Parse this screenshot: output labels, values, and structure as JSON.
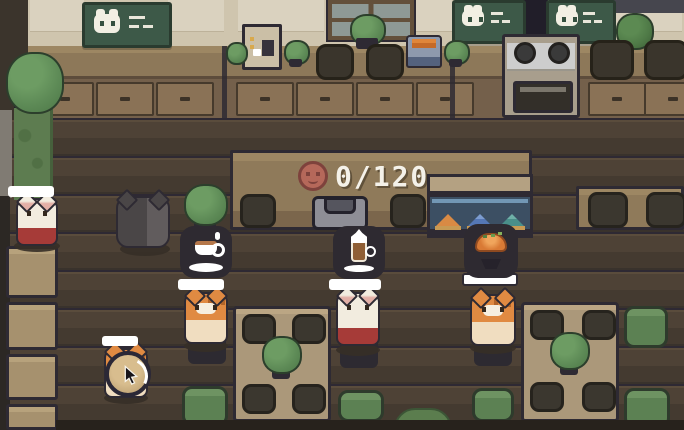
{
  "hud": {
    "order_counter": {
      "icon": "coin-icon",
      "value": "0/120"
    }
  },
  "signs": {
    "menu_boards": [
      {
        "name": "menu-board-left",
        "icon": "cat-face-icon",
        "content": "menu-lines"
      },
      {
        "name": "menu-board-right-1",
        "icon": "cat-face-icon",
        "content": "menu-lines"
      },
      {
        "name": "menu-board-right-2",
        "icon": "cat-face-icon",
        "content": "menu-lines"
      }
    ]
  },
  "entities": {
    "customers": [
      {
        "name": "customer-cat-left",
        "species": "orange-tabby",
        "order_icon": "coffee-cup-icon"
      },
      {
        "name": "customer-cat-center",
        "species": "white-cat",
        "order_icon": "latte-icon"
      },
      {
        "name": "customer-cat-right",
        "species": "orange-tabby",
        "order_icon": "katsu-bowl-icon"
      }
    ],
    "staff": [
      {
        "name": "staff-cat",
        "species": "white-cat-red-apron"
      },
      {
        "name": "black-cat",
        "species": "black-cat"
      }
    ],
    "waiting": [
      {
        "name": "waiting-cat",
        "species": "orange-tabby",
        "indicator": "clock-icon",
        "cursor": "cursor-icon"
      }
    ],
    "kitchen": [
      "espresso-machine",
      "toaster",
      "stove",
      "display-case",
      "serving-tray"
    ],
    "display_case_items": [
      "sandwich-orange",
      "sandwich-blue",
      "sandwich-teal"
    ]
  },
  "palette": {
    "wall": "#cfc5ae",
    "wall_light": "#dad2bf",
    "wood_counter": "#8d7859",
    "wood_cabinet": "#74604b",
    "drawer": "#8a7256",
    "floor_a": "#4e4236",
    "floor_b": "#443a30",
    "floor_seam": "#2e2933",
    "outline_navy": "#2e2a33",
    "board_green": "#3d5948",
    "board_frame": "#2a3b2f",
    "plant_green": "#5d8a56",
    "plant_dark": "#466c41",
    "cushion_green": "#5c8153",
    "cushion_edge": "#2e3b2c",
    "table_tan": "#ab987a",
    "table_left": "#a6916e",
    "plate_dark": "#3b372f",
    "bubble_dark": "#2e2a31",
    "bar_white": "#ffffff",
    "coin_copper": "#b5685a",
    "coin_edge": "#7e423c",
    "cat_orange": "#e08a42",
    "cat_cream": "#f0ddc0",
    "cat_white": "#f2ecdf",
    "cat_black": "#4a4647",
    "apron_red": "#a63b38",
    "glass_blue": "#7fa9c9",
    "case_back": "#3c4f63",
    "stove_gray": "#cdcdcd",
    "toaster_blue": "#54627e",
    "bread_orange": "#e0863a",
    "tray_gray": "#8e8e96",
    "text_white": "#f4f1e9",
    "window_glass": "#8e9995",
    "door_dark": "#211e29",
    "column_green": "#5d7c50",
    "shadow_brown": "#362f27"
  }
}
